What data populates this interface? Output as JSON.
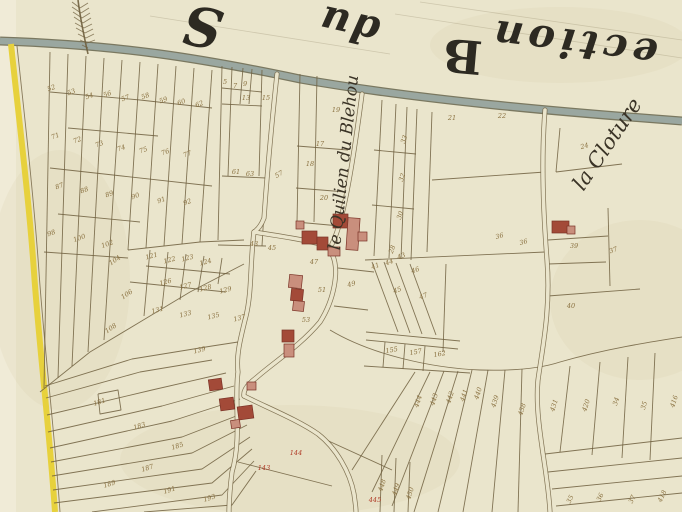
{
  "map": {
    "kind": "historical-cadastre-plan",
    "canvas": {
      "width": 682,
      "height": 512
    },
    "colors": {
      "parchment": "#eae5cc",
      "parchment_light": "#f1ecd9",
      "stain": "#d9cfa6",
      "road_grey": "#9aa7a0",
      "road_edge": "#6e6b54",
      "yellow": "#e7d13c",
      "ink": "#6f5f3e",
      "number_ink": "#8a7140",
      "number_red": "#b03a26",
      "building_dark": "#a34a38",
      "building_light": "#c98f7d",
      "building_edge": "#7a3226",
      "label_ink": "#3a3326",
      "title_ink": "#2d2a22"
    },
    "title_fragments": [
      {
        "text": "ection",
        "x": 575,
        "y": 30,
        "rot": 187,
        "size": 40,
        "italic": true,
        "spacing": 5
      },
      {
        "text": "B",
        "x": 464,
        "y": 40,
        "rot": 185,
        "size": 46,
        "italic": false,
        "spacing": 0
      },
      {
        "text": "du",
        "x": 352,
        "y": 12,
        "rot": 193,
        "size": 40,
        "italic": true,
        "spacing": 2
      },
      {
        "text": "S",
        "x": 206,
        "y": 8,
        "rot": 190,
        "size": 54,
        "italic": true,
        "spacing": 0
      }
    ],
    "place_labels": [
      {
        "text": "le Quilien du Blehou",
        "x": 349,
        "y": 163,
        "rot": -84,
        "size": 17
      },
      {
        "text": "la Cloture",
        "x": 613,
        "y": 148,
        "rot": -56,
        "size": 21
      }
    ],
    "guide_lines": [
      "M150,16 L390,54",
      "M395,14 L682,58",
      "M420,2 L682,40"
    ],
    "grey_road": {
      "path": "M0,41 C120,45 200,58 300,79 C420,100 560,112 682,121"
    },
    "yellow_road": {
      "path": "M11,44 C19,120 29,200 34,272 C39,345 49,425 55,512",
      "edge": "M17,46 C25,120 34,200 39,272 C44,345 54,425 60,512"
    },
    "village_roads": [
      "M277,74 C271,130 267,175 264,218 C261,226 257,230 254,232",
      "M362,94 C356,140 349,188 341,218 C338,230 335,238 332,244",
      "M254,232 C250,262 252,292 246,316 C240,340 236,356 238,372 C234,402 242,438 232,472 C230,488 229,500 229,512",
      "M254,232 C280,236 306,240 324,245 C332,247 330,250 332,254 C340,270 334,300 320,322 C300,346 274,362 256,378 C248,384 243,390 244,396",
      "M545,110 C541,160 543,210 547,260 C551,310 542,350 538,380 C534,420 548,470 550,512",
      "M244,396 C268,408 298,420 318,434 C336,448 350,472 354,494 C355,502 356,507 356,512"
    ],
    "parcel_lines": [
      "M50,52 L44,388",
      "M68,54 L58,378",
      "M86,56 L72,366",
      "M104,58 L88,352",
      "M122,60 L104,340",
      "M140,62 L128,250",
      "M158,64 L146,248",
      "M176,66 L164,246",
      "M194,68 L182,244",
      "M212,70 L200,242",
      "M50,92 L140,100",
      "M140,100 L212,108",
      "M68,128 L158,136",
      "M50,168 L122,176",
      "M122,176 L212,186",
      "M58,214 L140,222",
      "M44,252 L128,258",
      "M40,392 L90,352 L140,322 L190,292 L244,264",
      "M128,250 L200,242 L244,240",
      "M150,250 L144,316",
      "M168,252 L162,308",
      "M186,254 L180,300",
      "M204,256 L198,292",
      "M222,258 L218,284",
      "M130,282 L226,292",
      "M146,266 L230,274",
      "M222,66 L218,240",
      "M232,67 L228,176",
      "M243,68 L240,104",
      "M252,69 L249,104",
      "M262,70 L259,176",
      "M222,88 L262,92",
      "M222,104 L262,106",
      "M222,176 L266,178",
      "M266,178 L262,246",
      "M218,245 L266,246",
      "M300,74 L297,222",
      "M317,76 L314,222",
      "M297,146 L348,150",
      "M296,188 L346,192",
      "M296,222 L340,226",
      "M382,100 L374,256",
      "M396,104 L389,258",
      "M407,107 L401,259",
      "M417,109 L411,260",
      "M374,150 L416,154",
      "M372,205 L414,209",
      "M365,260 L545,252",
      "M432,112 L427,252",
      "M432,180 L545,172",
      "M560,128 L556,172",
      "M556,172 L622,164",
      "M548,240 L608,236",
      "M608,208 L610,286",
      "M548,264 L606,262",
      "M548,296 L640,289",
      "M372,262 L398,332",
      "M384,262 L410,333",
      "M396,263 L422,334",
      "M410,264 L436,335",
      "M446,264 L443,352",
      "M366,332 L460,341",
      "M385,342 L383,367",
      "M405,344 L403,369",
      "M425,346 L423,371",
      "M366,340 L458,349",
      "M364,366 L470,373",
      "M338,268 L374,272",
      "M334,306 L368,310",
      "M330,330 C370,354 430,368 480,370 C515,371 542,368 560,362 C605,349 650,342 682,337",
      "M46,398 L140,372 L212,360",
      "M47,415 L152,390 L226,373",
      "M48,432 L162,406 L234,386",
      "M50,448 L172,421 L240,399",
      "M51,462 L182,437 L244,413",
      "M52,476 L192,453 L247,425",
      "M53,490 L202,469 L250,437",
      "M54,503 L212,483 L252,449",
      "M92,512 L222,495 L254,461",
      "M144,512 L232,505 L256,471",
      "M45,386 L132,359 L212,346 L238,342",
      "M98,394 L118,390 L121,410 L100,414 L98,394",
      "M238,462 L332,486",
      "M322,438 L392,470",
      "M382,455 L380,512",
      "M396,458 L394,512",
      "M410,462 L408,512",
      "M415,372 L352,470",
      "M430,372 L372,492",
      "M444,371 L392,506",
      "M458,371 L414,512",
      "M472,370 L438,512",
      "M488,370 L463,512",
      "M505,370 L492,512",
      "M522,369 L518,512",
      "M570,366 L560,452",
      "M600,362 L592,455",
      "M628,357 L622,458",
      "M655,353 L650,460",
      "M545,454 L682,438",
      "M548,472 L682,458",
      "M552,489 L682,476",
      "M556,506 L682,493"
    ],
    "buildings": [
      [
        333,
        214,
        15,
        14,
        0,
        "d"
      ],
      [
        347,
        218,
        12,
        32,
        4,
        "l"
      ],
      [
        302,
        231,
        15,
        13,
        0,
        "d"
      ],
      [
        317,
        237,
        11,
        13,
        0,
        "d"
      ],
      [
        328,
        247,
        12,
        9,
        0,
        "l"
      ],
      [
        296,
        221,
        8,
        8,
        0,
        "l"
      ],
      [
        358,
        232,
        9,
        9,
        0,
        "l"
      ],
      [
        289,
        275,
        13,
        13,
        6,
        "l"
      ],
      [
        291,
        289,
        12,
        12,
        6,
        "d"
      ],
      [
        293,
        301,
        11,
        10,
        6,
        "l"
      ],
      [
        282,
        330,
        12,
        12,
        0,
        "d"
      ],
      [
        284,
        344,
        10,
        13,
        0,
        "l"
      ],
      [
        209,
        379,
        13,
        11,
        -8,
        "d"
      ],
      [
        220,
        398,
        14,
        12,
        -8,
        "d"
      ],
      [
        238,
        406,
        15,
        13,
        -8,
        "d"
      ],
      [
        247,
        382,
        9,
        8,
        0,
        "l"
      ],
      [
        231,
        420,
        9,
        8,
        -8,
        "l"
      ],
      [
        552,
        221,
        17,
        12,
        0,
        "d"
      ],
      [
        567,
        226,
        8,
        8,
        0,
        "l"
      ]
    ],
    "parcel_numbers": [
      [
        "52",
        52,
        90,
        -20
      ],
      [
        "53",
        72,
        94,
        -20
      ],
      [
        "54",
        90,
        98,
        -20
      ],
      [
        "56",
        108,
        96,
        -20
      ],
      [
        "57",
        126,
        100,
        -20
      ],
      [
        "58",
        146,
        98,
        -20
      ],
      [
        "59",
        164,
        102,
        -20
      ],
      [
        "60",
        182,
        104,
        -20
      ],
      [
        "62",
        200,
        106,
        -20
      ],
      [
        "71",
        56,
        138,
        -20
      ],
      [
        "72",
        78,
        142,
        -20
      ],
      [
        "73",
        100,
        146,
        -20
      ],
      [
        "74",
        122,
        150,
        -20
      ],
      [
        "75",
        144,
        152,
        -20
      ],
      [
        "76",
        166,
        154,
        -20
      ],
      [
        "77",
        188,
        156,
        -20
      ],
      [
        "87",
        60,
        188,
        -20
      ],
      [
        "88",
        85,
        192,
        -20
      ],
      [
        "89",
        110,
        196,
        -20
      ],
      [
        "90",
        136,
        198,
        -20
      ],
      [
        "91",
        162,
        202,
        -20
      ],
      [
        "92",
        188,
        204,
        -20
      ],
      [
        "98",
        52,
        235,
        -20
      ],
      [
        "100",
        80,
        240,
        -20
      ],
      [
        "102",
        108,
        246,
        -20
      ],
      [
        "104",
        116,
        262,
        -35
      ],
      [
        "106",
        128,
        296,
        -35
      ],
      [
        "108",
        112,
        330,
        -35
      ],
      [
        "121",
        152,
        258,
        -15
      ],
      [
        "122",
        170,
        262,
        -15
      ],
      [
        "123",
        188,
        260,
        -15
      ],
      [
        "124",
        206,
        264,
        -15
      ],
      [
        "126",
        166,
        284,
        -15
      ],
      [
        "127",
        186,
        288,
        -15
      ],
      [
        "128",
        206,
        290,
        -15
      ],
      [
        "129",
        226,
        292,
        -15
      ],
      [
        "131",
        158,
        312,
        -15
      ],
      [
        "133",
        186,
        316,
        -15
      ],
      [
        "135",
        214,
        318,
        -15
      ],
      [
        "137",
        240,
        320,
        -15
      ],
      [
        "5",
        225,
        84,
        0
      ],
      [
        "7",
        235,
        88,
        0
      ],
      [
        "9",
        245,
        86,
        0
      ],
      [
        "13",
        246,
        100,
        0
      ],
      [
        "15",
        266,
        100,
        0
      ],
      [
        "61",
        236,
        174,
        0
      ],
      [
        "63",
        250,
        176,
        0
      ],
      [
        "57",
        280,
        176,
        -30
      ],
      [
        "18",
        310,
        166,
        0
      ],
      [
        "19",
        336,
        112,
        0
      ],
      [
        "17",
        320,
        146,
        0
      ],
      [
        "20",
        324,
        200,
        0
      ],
      [
        "33",
        406,
        140,
        -70
      ],
      [
        "32",
        404,
        178,
        -70
      ],
      [
        "30",
        402,
        216,
        -70
      ],
      [
        "28",
        394,
        250,
        -70
      ],
      [
        "21",
        452,
        120,
        0
      ],
      [
        "22",
        502,
        118,
        0
      ],
      [
        "24",
        585,
        148,
        -15
      ],
      [
        "36",
        500,
        238,
        -15
      ],
      [
        "36",
        524,
        244,
        -15
      ],
      [
        "37",
        614,
        252,
        -20
      ],
      [
        "39",
        574,
        248,
        0
      ],
      [
        "40",
        571,
        308,
        0
      ],
      [
        "41",
        376,
        268,
        -20
      ],
      [
        "44",
        390,
        264,
        -20
      ],
      [
        "43",
        402,
        258,
        -20
      ],
      [
        "45",
        398,
        292,
        -20
      ],
      [
        "46",
        416,
        272,
        -20
      ],
      [
        "47",
        424,
        298,
        -20
      ],
      [
        "155",
        392,
        352,
        -10
      ],
      [
        "157",
        416,
        354,
        -10
      ],
      [
        "162",
        440,
        356,
        -10
      ],
      [
        "43",
        254,
        246,
        0
      ],
      [
        "45",
        272,
        250,
        0
      ],
      [
        "47",
        314,
        264,
        0
      ],
      [
        "49",
        352,
        286,
        -15
      ],
      [
        "51",
        322,
        292,
        0
      ],
      [
        "53",
        306,
        322,
        0
      ],
      [
        "139",
        200,
        352,
        -15
      ],
      [
        "181",
        100,
        404,
        -18
      ],
      [
        "183",
        140,
        428,
        -18
      ],
      [
        "185",
        178,
        448,
        -18
      ],
      [
        "187",
        148,
        470,
        -18
      ],
      [
        "189",
        110,
        486,
        -18
      ],
      [
        "191",
        170,
        492,
        -18
      ],
      [
        "193",
        210,
        500,
        -18
      ],
      [
        "144",
        296,
        455,
        0,
        "red"
      ],
      [
        "143",
        264,
        470,
        0,
        "red"
      ],
      [
        "445",
        375,
        502,
        0,
        "red"
      ],
      [
        "444",
        420,
        402,
        -72
      ],
      [
        "443",
        436,
        400,
        -72
      ],
      [
        "442",
        452,
        398,
        -72
      ],
      [
        "441",
        466,
        396,
        -72
      ],
      [
        "440",
        480,
        394,
        -72
      ],
      [
        "439",
        497,
        402,
        -72
      ],
      [
        "438",
        524,
        410,
        -72
      ],
      [
        "431",
        556,
        406,
        -72
      ],
      [
        "420",
        588,
        406,
        -72
      ],
      [
        "34",
        618,
        402,
        -72
      ],
      [
        "35",
        646,
        406,
        -72
      ],
      [
        "416",
        676,
        402,
        -72
      ],
      [
        "35",
        572,
        500,
        -65
      ],
      [
        "36",
        602,
        498,
        -65
      ],
      [
        "37",
        634,
        500,
        -65
      ],
      [
        "418",
        664,
        497,
        -65
      ],
      [
        "448",
        384,
        486,
        -72
      ],
      [
        "449",
        398,
        490,
        -72
      ],
      [
        "450",
        412,
        494,
        -72
      ]
    ],
    "stains": [
      [
        560,
        45,
        130,
        38
      ],
      [
        290,
        460,
        170,
        55
      ],
      [
        60,
        280,
        70,
        130
      ],
      [
        640,
        300,
        90,
        80
      ]
    ],
    "feather": {
      "stem": "M78,0 C80,16 83,32 88,54",
      "barbs": "M80,8 L72,2 M81,13 L72,7 M82,18 L73,12 M83,23 L74,17 M84,28 L75,23 M85,33 L76,28 M86,38 L78,34 M87,43 L80,40 M88,48 L82,45 M80,8 L88,3 M81,13 L89,8 M82,18 L90,13 M83,23 L91,18 M84,28 L92,24 M85,33 L93,29 M86,38 L94,34 M87,43 L95,40"
    }
  }
}
